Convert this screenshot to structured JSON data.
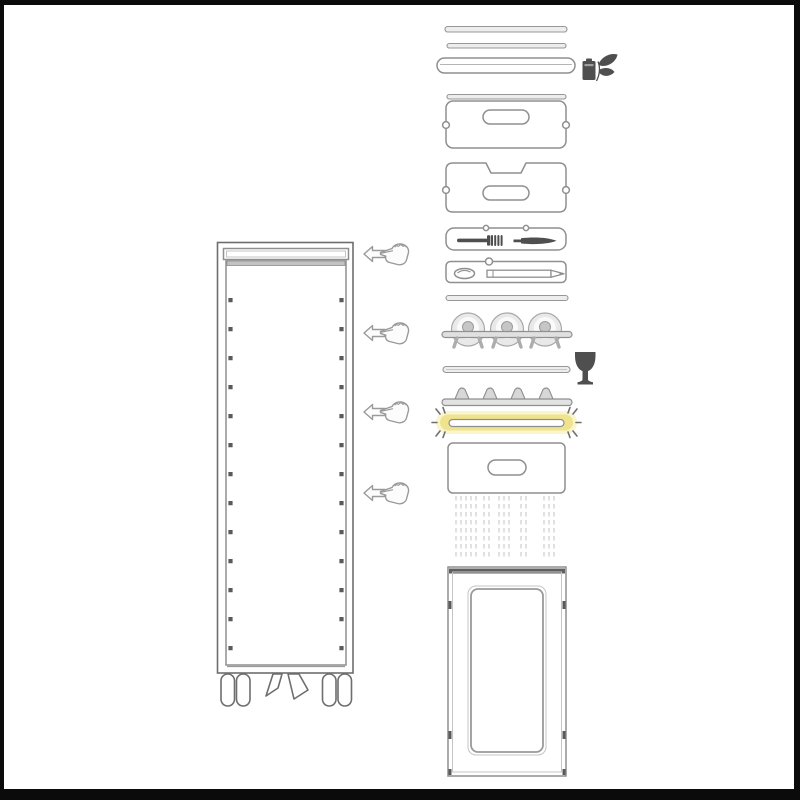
{
  "canvas": {
    "width": 800,
    "height": 800,
    "background": "#ffffff"
  },
  "frame": {
    "color": "#0b0b0b",
    "top_px": 5,
    "side_px": 5,
    "bottom_px": 11
  },
  "colors": {
    "outline": "#8f8f8f",
    "outline_dark": "#6e6e6e",
    "fill_light": "#ededed",
    "icon_dark": "#4f4f4f",
    "door_bar": "#5f5f5f",
    "highlight_yellow": "#efe48d",
    "highlight_glow": "#faf5cd",
    "drip_line": "#d4d4d4"
  },
  "trolley": {
    "name": "service-trolley-cabinet",
    "slot_dot_rows": 13,
    "wheels": 4,
    "brake_pedals": 2
  },
  "cursors": {
    "count": 4,
    "icon": "hand-pointing-left-with-arrow"
  },
  "highlight": {
    "part": "highlighted-rail",
    "state": "selected"
  },
  "parts": [
    {
      "name": "top-slat-upper"
    },
    {
      "name": "top-slat-lower"
    },
    {
      "name": "top-rail-pill"
    },
    {
      "name": "eco-battery-leaf-icon"
    },
    {
      "name": "slat-under-rail"
    },
    {
      "name": "tray-with-handle-plain"
    },
    {
      "name": "tray-with-handle-notched"
    },
    {
      "name": "cutlery-tray-fork-knife"
    },
    {
      "name": "utensil-tray-opener-pencil"
    },
    {
      "name": "slat-mid"
    },
    {
      "name": "plate-rack-three-plates"
    },
    {
      "name": "slat-lower"
    },
    {
      "name": "wine-glass-icon"
    },
    {
      "name": "pronged-rail"
    },
    {
      "name": "highlighted-rail"
    },
    {
      "name": "tray-with-handle-bottom"
    },
    {
      "name": "drip-guide-lines"
    },
    {
      "name": "door-panel"
    }
  ]
}
